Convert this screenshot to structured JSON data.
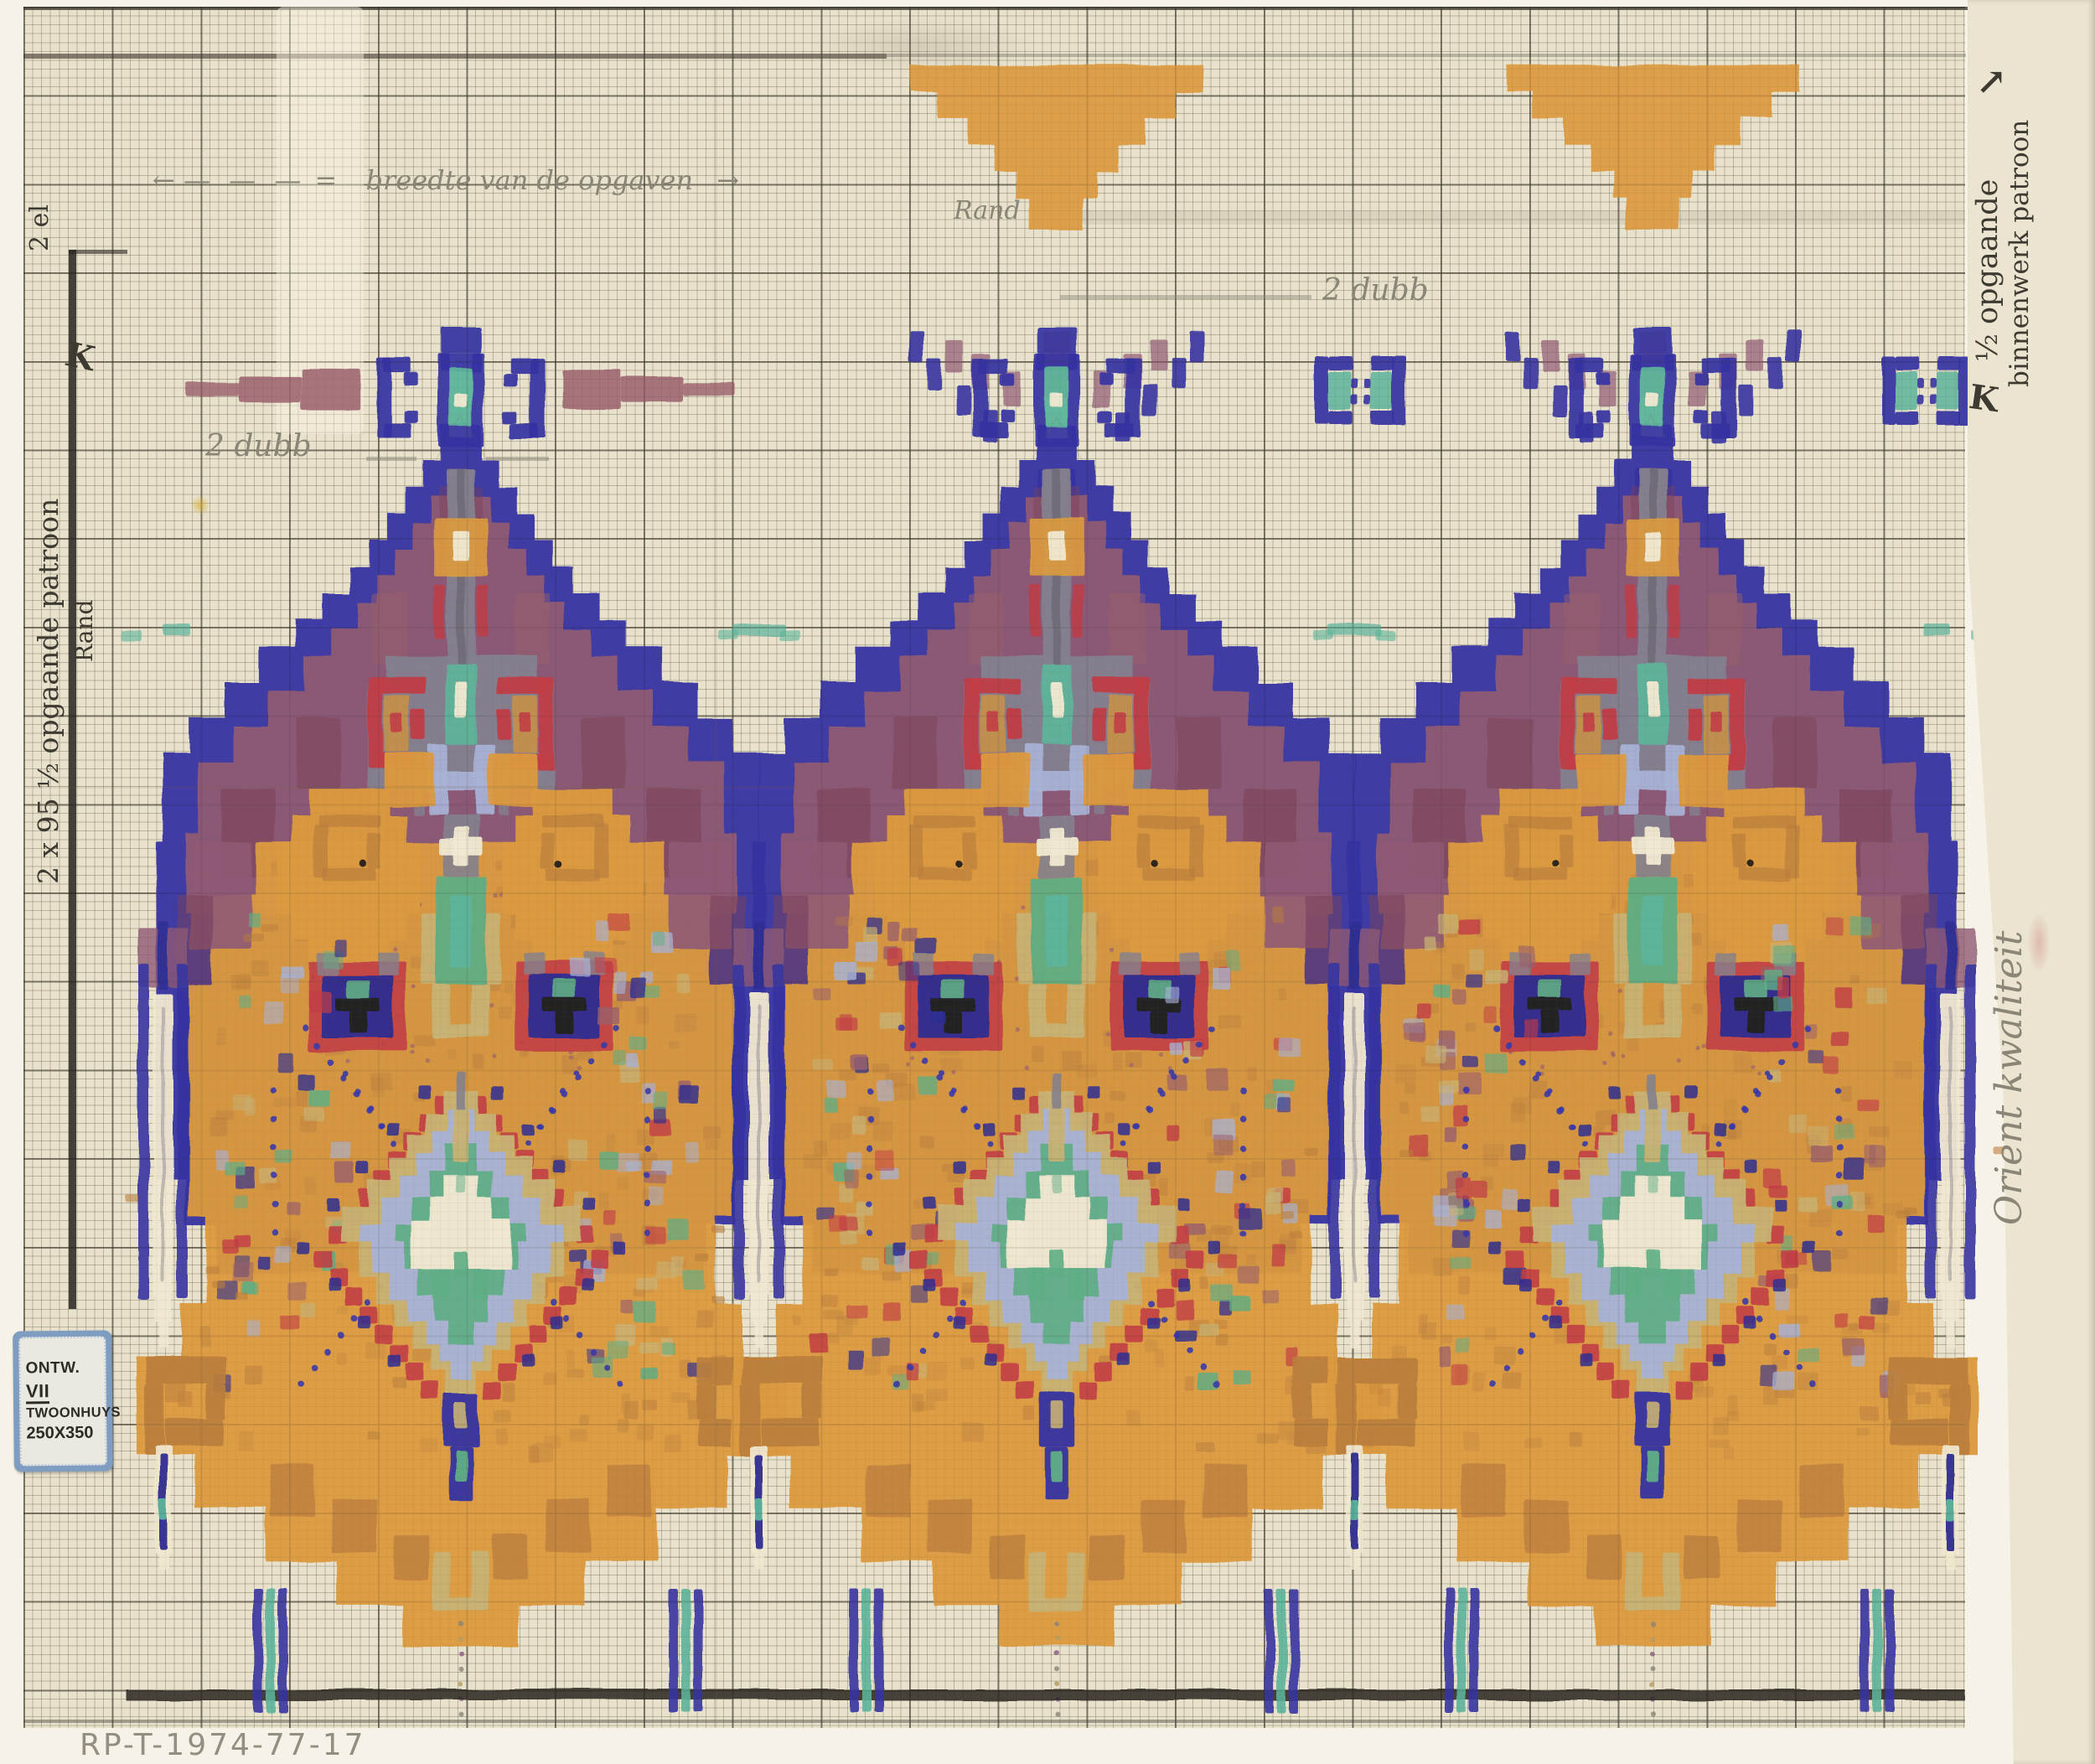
{
  "artwork": {
    "type": "hand-painted carpet design on graph paper",
    "inventory_number": "RP-T-1974-77-17"
  },
  "label": {
    "prefix": "ONTW.",
    "number": "VII",
    "line2": "TWOONHUYS",
    "line3": "250X350"
  },
  "annotations": {
    "top_note": "breedte van de opgaven",
    "top_note_sub": "Rand",
    "dub_left": "2 dubb",
    "dub_right": "2 dubb",
    "left_ink_top": "2 el",
    "left_margin_line1": "2 x 95  ½ opgaande patroon",
    "left_margin_line2": "Rand",
    "right_strip_line1": "½ opgaande",
    "right_strip_line2": "binnenwerk patroon",
    "right_strip_line3": "Orient kwaliteit"
  },
  "icons": {
    "k_arrow": "K",
    "ne_arrow": "↗",
    "arrow_left": "←",
    "arrow_right": "→",
    "dashes": "— — —",
    "equals": "="
  },
  "palette": {
    "paper": "#e8e2cc",
    "strip_paper": "#ebe4d0",
    "page_bg": "#f6f2e7",
    "cobalt": "#3634a2",
    "navy": "#2e2d92",
    "mauve": "#8f5a74",
    "plum": "#7b4156",
    "wine": "#9a5f6b",
    "slate": "#84818f",
    "orange": "#dc9a3f",
    "ochre": "#bb7f3c",
    "red": "#c23c45",
    "gold": "#c79148",
    "green": "#5fae85",
    "teal": "#5cb49b",
    "periwinkle": "#a8b2d5",
    "tan": "#c8b274",
    "cream": "#efe7cf",
    "black_paint": "#241f1c",
    "pencil": "#8b8578",
    "ink": "#3d3a32",
    "label_blue": "#7e9dc1"
  }
}
